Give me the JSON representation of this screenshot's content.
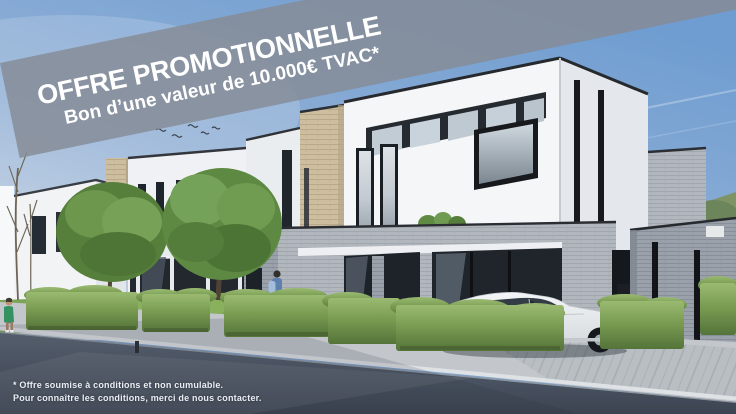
{
  "banner": {
    "title": "OFFRE PROMOTIONNELLE",
    "subtitle": "Bon d’une valeur de 10.000€ TVAC*",
    "overlay_color": "rgba(134,140,150,0.84)",
    "text_color": "#FFFFFF"
  },
  "footnote": {
    "line1": "* Offre soumise à conditions et non cumulable.",
    "line2": "Pour connaître les conditions, merci de nous contacter.",
    "text_color": "#EAEEF2"
  },
  "scene": {
    "colors": {
      "sky_top": "#6F9DD1",
      "sky_horizon": "#CCD7E2",
      "wall_white": "#F5F6F8",
      "wall_shade": "#E4E7EB",
      "brick_beige": "#CDBEA0",
      "brick_gray_light": "#B2B7BD",
      "brick_gray_dark": "#9AA1AA",
      "glass_dark": "#21262D",
      "hedge_green": "#6E8F4D",
      "lawn_green": "#7CA455",
      "tree_green": "#5E8A41",
      "road": "#49525F",
      "pavement": "#C3C7CC",
      "curb": "#DFE2E5",
      "car_body": "#EDEFF1"
    }
  }
}
